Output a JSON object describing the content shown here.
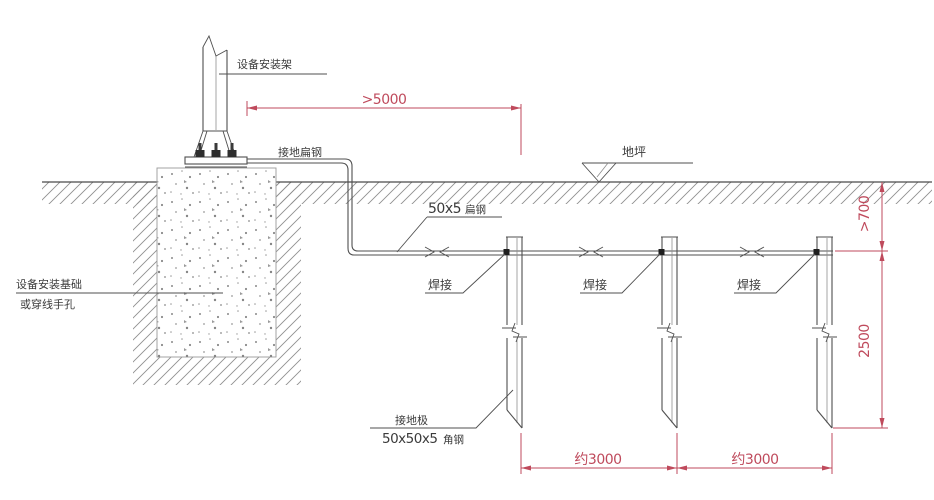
{
  "drawing": {
    "labels": {
      "mount_frame": "设备安装架",
      "grounding_flat_steel": "接地扁钢",
      "foundation_line1": "设备安装基础",
      "foundation_line2": "或穿线手孔",
      "flat_steel_spec_num": "50x5",
      "flat_steel_spec_suffix": "扁钢",
      "ground_level": "地坪",
      "weld_1": "焊接",
      "weld_2": "焊接",
      "weld_3": "焊接",
      "electrode_name": "接地极",
      "electrode_spec_num": "50x50x5",
      "electrode_spec_suffix": "角钢"
    },
    "dimensions": {
      "top_span": ">5000",
      "burial_depth": ">700",
      "electrode_length": "2500",
      "spacing_1": "约3000",
      "spacing_2": "约3000"
    },
    "colors": {
      "line": "#4f4f4f",
      "dimension": "#bf4a5c",
      "text": "#3b3b3b"
    }
  }
}
